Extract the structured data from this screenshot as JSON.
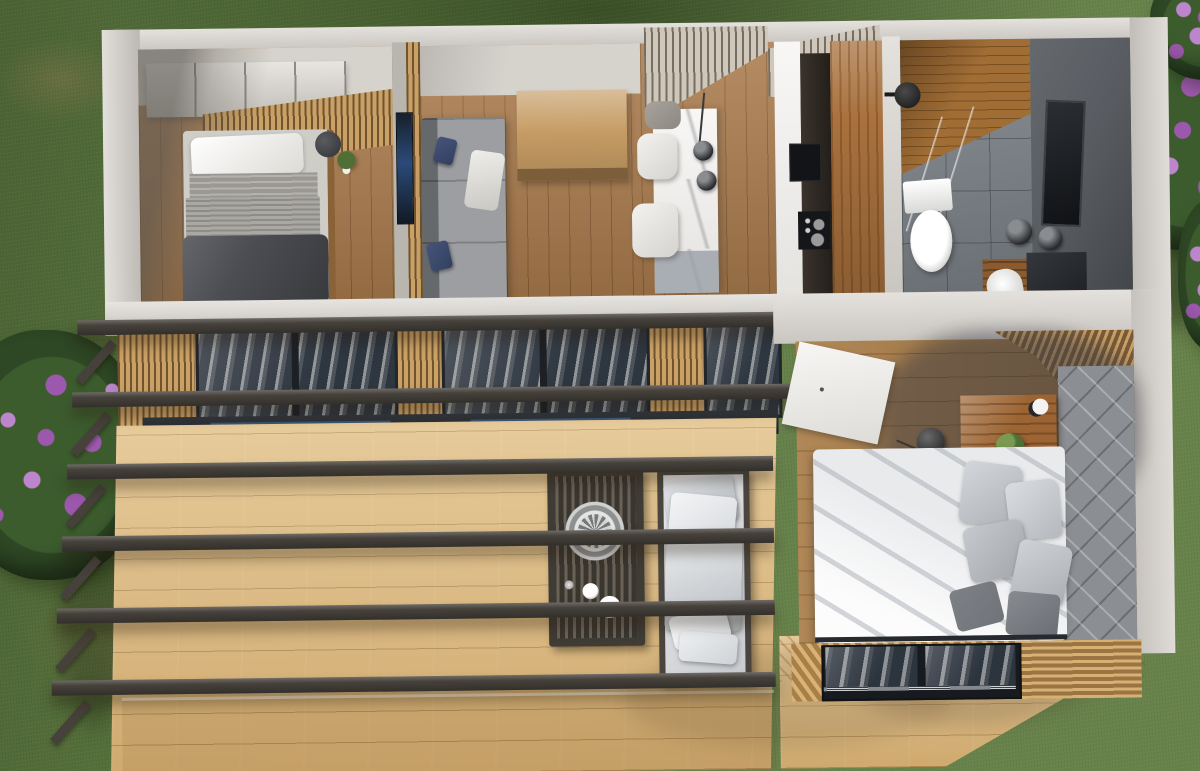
{
  "palette": {
    "grassBase": "#5c7840",
    "grassDark": "#31471f",
    "bushGreen": "#2e4724",
    "flowerPurple": "#9c58ac",
    "flowerPurpleLight": "#bd86cc",
    "wallLight": "#d6d2cc",
    "wallShade": "#b9b5af",
    "floorWood": "#ab7c4d",
    "floorWoodDark": "#8a6238",
    "slatWood": "#c9a066",
    "deckWood": "#dcb87c",
    "beamDark": "#46413b",
    "glassDark": "#2e3640",
    "glassNavy": "#2e4663",
    "marble": "#f1efec",
    "marbleShade": "#9aa0a7",
    "cabinetWood": "#a9713d",
    "bathTile": "#7b8187",
    "bathWallDark": "#585c61",
    "sofaGray": "#8e9195",
    "navyPillow": "#32405f",
    "bedDuvetDark": "#4b4d52",
    "bedBlanket": "#9b9893",
    "bed2Duvet": "#e9eaec",
    "pillowDark": "#707479",
    "headboard": "#8b8e92",
    "nightWood": "#9c6433",
    "plantGreen": "#4f6f36"
  },
  "scene": {
    "type": "aerial-3d-render-tiny-house",
    "environment": [
      "lawn",
      "soil-patches",
      "flower-bush-left",
      "flower-bush-top-right",
      "flower-bush-right-edge",
      "hedge-shadow-top"
    ],
    "rooms": [
      {
        "name": "bedroom-1",
        "furniture": [
          "wardrobe",
          "slat-accent-wall",
          "single-bed",
          "pillow",
          "blanket",
          "dark-duvet",
          "round-side-table",
          "potted-plant"
        ]
      },
      {
        "name": "living-room",
        "furniture": [
          "tv-partition-wall",
          "tv",
          "gray-sofa",
          "navy-cushions",
          "white-throw",
          "wood-sideboard"
        ]
      },
      {
        "name": "dining-area",
        "furniture": [
          "slat-ceiling",
          "marble-island",
          "pendant-lamp",
          "pendant-lamp",
          "white-chair",
          "white-chair",
          "gray-chair"
        ]
      },
      {
        "name": "kitchen",
        "furniture": [
          "marble-counter",
          "wall-oven",
          "cooktop",
          "tall-wood-cabinet"
        ]
      },
      {
        "name": "bathroom",
        "furniture": [
          "wood-shower-floor",
          "glass-shower-screen",
          "shower-head",
          "toilet",
          "dark-feature-wall",
          "mirror",
          "pendant-lamp",
          "pendant-lamp",
          "vanity",
          "sink"
        ]
      },
      {
        "name": "bedroom-2",
        "furniture": [
          "entry-door",
          "slat-wall",
          "quilted-headboard-wall",
          "nightstand",
          "potted-plant",
          "pendant-lamp",
          "wall-lamp",
          "double-bed",
          "gray-pillows",
          "dark-pillows",
          "facade-window"
        ]
      }
    ],
    "exterior": [
      "front-glazing",
      "sliding-door-track",
      "pergola-beam-x6",
      "pergola-posts",
      "wood-deck",
      "deck-step",
      "outdoor-slatted-table",
      "decor-bowl",
      "plates",
      "outdoor-bench",
      "white-cushions"
    ]
  }
}
